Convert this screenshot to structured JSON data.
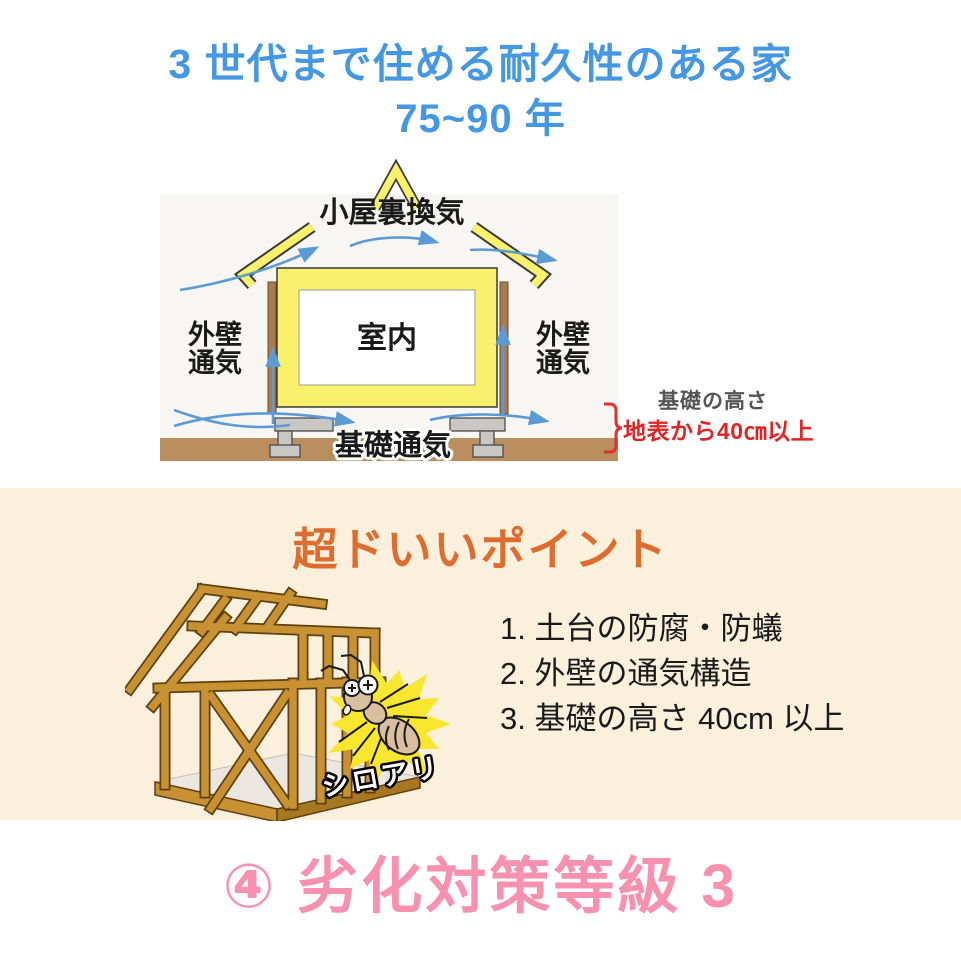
{
  "header": {
    "title_line1": "3 世代まで住める耐久性のある家",
    "title_line2": "75~90 年"
  },
  "diagram": {
    "attic_label": "小屋裏換気",
    "room_label": "室内",
    "wall_left_line1": "外壁",
    "wall_left_line2": "通気",
    "wall_right_line1": "外壁",
    "wall_right_line2": "通気",
    "foundation_label": "基礎通気",
    "height_note_title": "基礎の高さ",
    "height_note_value": "地表から40㎝以上"
  },
  "points": {
    "title": "超ドいいポイント",
    "items": [
      "1. 土台の防腐・防蟻",
      "2. 外壁の通気構造",
      "3. 基礎の高さ 40cm 以上"
    ],
    "termite_label": "シロアリ"
  },
  "footer": {
    "grade_label": "④ 劣化対策等級 3"
  },
  "colors": {
    "title_blue": "#4497E3",
    "points_orange": "#DD6C2E",
    "grade_pink": "#F890B0",
    "note_red": "#E32222",
    "section_beige": "#FAF0DC",
    "wall_yellow": "#F9F16B",
    "arrow_blue": "#5B9BD5",
    "wood_gold": "#C89232"
  }
}
